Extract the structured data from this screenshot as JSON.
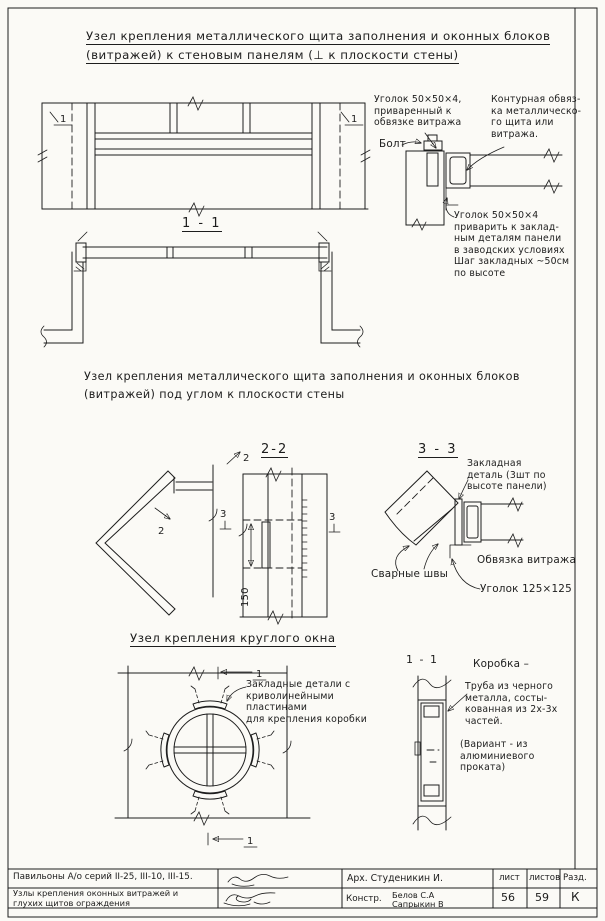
{
  "titles": {
    "t1_line1": "Узел  крепления  металлического  щита  заполнения  и  оконных  блоков",
    "t1_line2": "(витражей)  к  стеновым  панелям  (⊥ к  плоскости  стены)",
    "t2_line1": "Узел крепления металлического щита  заполнения и оконных блоков",
    "t2_line2": "(витражей)  под  углом  к плоскости  стены",
    "t3": "Узел  крепления  круглого  окна"
  },
  "sections": {
    "plan11": "1 - 1",
    "s22": "2-2",
    "s33": "3 - 3",
    "round11": "1 - 1"
  },
  "marks": {
    "one": "1",
    "two": "2",
    "three": "3"
  },
  "dims": {
    "d150": "150"
  },
  "annotations": {
    "angle_welded": "Уголок 50×50×4,\nприваренный к\nобвязке витража",
    "bolt": "Болт",
    "contour": "Контурная обвяз-\nка металлическо-\nго щита или\nвитража.",
    "angle_site": "Уголок 50×50×4\nприварить к заклад-\nным деталям панели\nв заводских условиях\nШаг закладных ~50см\nпо высоте",
    "embed_detail": "Закладная\nдеталь (3шт по\nвысоте панели)",
    "weld_seams": "Сварные швы",
    "vitrage_frame": "Обвязка витража",
    "angle125": "Уголок 125×125",
    "embed_plates": "Закладные детали с\nкриволинейными\nпластинами\nдля крепления коробки",
    "korobka_title": "Коробка –",
    "korobka_body": "Труба из черного\nметалла, состы-\nкованная из 2х-3х\nчастей.",
    "korobka_variant": "(Вариант - из\nалюминиевого\nпроката)"
  },
  "titleblock": {
    "project": "Павильоны  А/о серий  II-25, III-10, III-15.",
    "sheet_title": "Узлы крепления  оконных витражей и\nглухих щитов  ограждения",
    "arch": "Арх. Студеникин И.",
    "constr_label": "Констр.",
    "constr_name1": "Белов С.А",
    "constr_name2": "Сапрыкин В",
    "col_list": "лист",
    "col_listov": "листов",
    "col_razd": "Разд.",
    "val_list": "56",
    "val_listov": "59",
    "val_razd": "К"
  }
}
